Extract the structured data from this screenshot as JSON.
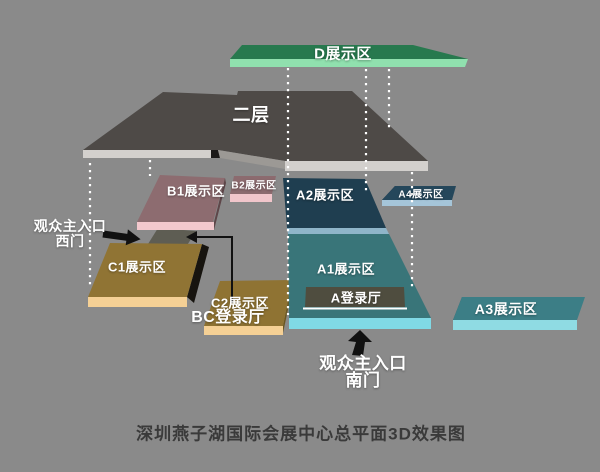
{
  "canvas": {
    "background": "#8a8a8a"
  },
  "caption": "深圳燕子湖国际会展中心总平面3D效果图",
  "palette": {
    "dotted_line": "#ffffff",
    "annotation": "#111111",
    "caption_color": "#3a3a3a",
    "label_color": "#ffffff"
  },
  "areas": {
    "d": {
      "label": "D展示区",
      "top": "#27794e",
      "edge": "#90e0ae"
    },
    "floor2": {
      "label": "二层",
      "top": "#4e4a47",
      "edge": "#d3d0cd",
      "ledge": "#9c9995",
      "step": "#1c1a19"
    },
    "b1": {
      "label": "B1展示区",
      "top": "#8d6c70",
      "edge": "#f3c8cd",
      "side": "#5e4649"
    },
    "b2": {
      "label": "B2展示区",
      "top": "#8c6b6f",
      "edge": "#f1c6cb"
    },
    "a2": {
      "label": "A2展示区",
      "top": "#1f3e50",
      "edge": "#8fb5c9"
    },
    "a1": {
      "label": "A1展示区",
      "top": "#397579",
      "edge": "#80d9e5"
    },
    "a_hall": {
      "label": "A登录厅",
      "fill": "#4f4d3f",
      "underline": "#ffffff"
    },
    "a4": {
      "label": "A4展示区",
      "top": "#25475b",
      "edge": "#a5c5d9",
      "side": "#132638"
    },
    "a3": {
      "label": "A3展示区",
      "top": "#3c7e86",
      "edge": "#8fdbe3",
      "side": "#24545b"
    },
    "c1": {
      "label": "C1展示区",
      "top": "#907434",
      "edge": "#f5d095",
      "shadow": "#17140f"
    },
    "c2": {
      "label": "C2展示区",
      "top": "#8f7333",
      "edge": "#f5d095",
      "side": "#6b5722"
    },
    "bc_hall": {
      "label": "BC登录厅",
      "fill": "#5e5d53"
    }
  },
  "entrances": {
    "west": {
      "line1": "观众主入口",
      "line2": "西门"
    },
    "south": {
      "line1": "观众主入口",
      "line2": "南门"
    }
  }
}
